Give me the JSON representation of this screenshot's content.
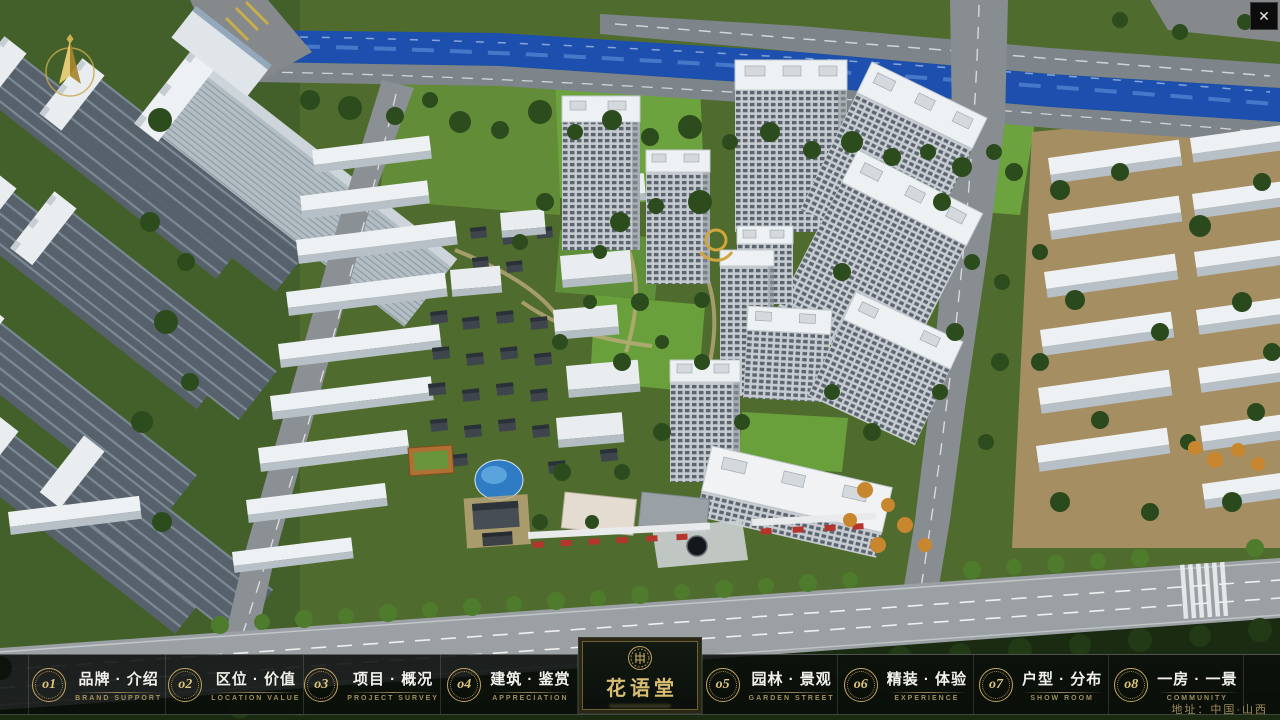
{
  "window": {
    "close_glyph": "✕"
  },
  "logo": {
    "name": "花语堂"
  },
  "menu": {
    "items": [
      {
        "num": "o1",
        "zh": "品牌 · 介绍",
        "en": "BRAND SUPPORT"
      },
      {
        "num": "o2",
        "zh": "区位 · 价值",
        "en": "LOCATION VALUE"
      },
      {
        "num": "o3",
        "zh": "项目 · 概况",
        "en": "PROJECT SURVEY"
      },
      {
        "num": "o4",
        "zh": "建筑 · 鉴赏",
        "en": "APPRECIATION"
      },
      {
        "num": "o5",
        "zh": "园林 · 景观",
        "en": "GARDEN STREET"
      },
      {
        "num": "o6",
        "zh": "精装 · 体验",
        "en": "EXPERIENCE"
      },
      {
        "num": "o7",
        "zh": "户型 · 分布",
        "en": "SHOW ROOM"
      },
      {
        "num": "o8",
        "zh": "一房 · 一景",
        "en": "COMMUNITY"
      }
    ]
  },
  "footer": {
    "address": "地址：中国·山西"
  },
  "colors": {
    "accent_gold": "#c9ae6a",
    "river_blue": "#1c4fae",
    "bar_bg": "#0a0e0b"
  }
}
